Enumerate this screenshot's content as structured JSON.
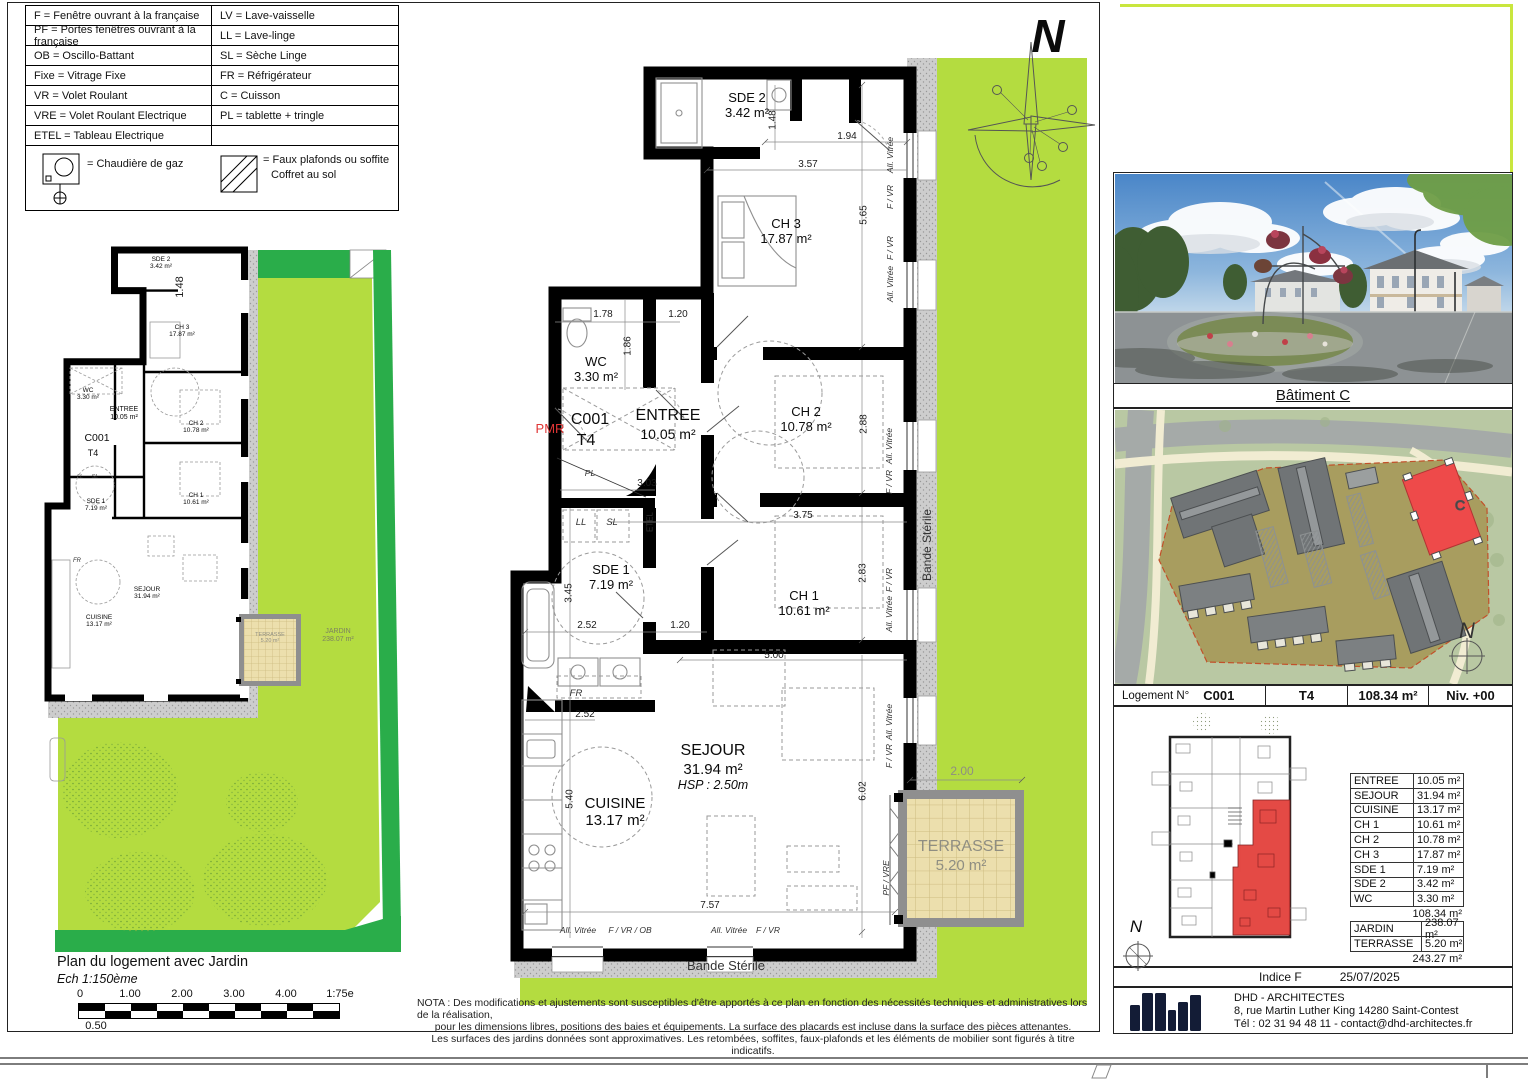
{
  "legend": {
    "rows": [
      {
        "l": "F = Fenêtre ouvrant à la française",
        "r": "LV = Lave-vaisselle"
      },
      {
        "l": "PF = Portes fenêtres ouvrant à la française",
        "r": "LL = Lave-linge"
      },
      {
        "l": "OB = Oscillo-Battant",
        "r": "SL = Sèche Linge"
      },
      {
        "l": "Fixe = Vitrage Fixe",
        "r": "FR = Réfrigérateur"
      },
      {
        "l": "VR = Volet Roulant",
        "r": "C = Cuisson"
      },
      {
        "l": "VRE = Volet Roulant Electrique",
        "r": "PL = tablette + tringle"
      },
      {
        "l": "ETEL = Tableau Electrique",
        "r": ""
      }
    ],
    "boiler": "= Chaudière de gaz",
    "soffit1": "= Faux plafonds ou soffite",
    "soffit2": "Coffret au sol"
  },
  "north": "N",
  "rooms": {
    "sde2": {
      "n": "SDE 2",
      "a": "3.42 m²"
    },
    "ch3": {
      "n": "CH 3",
      "a": "17.87 m²"
    },
    "wc": {
      "n": "WC",
      "a": "3.30 m²"
    },
    "entree": {
      "n": "ENTREE",
      "a": "10.05 m²"
    },
    "ch2": {
      "n": "CH 2",
      "a": "10.78 m²"
    },
    "sde1": {
      "n": "SDE 1",
      "a": "7.19 m²"
    },
    "ch1": {
      "n": "CH 1",
      "a": "10.61 m²"
    },
    "sejour": {
      "n": "SEJOUR",
      "a": "31.94 m²"
    },
    "cuisine": {
      "n": "CUISINE",
      "a": "13.17 m²"
    },
    "terrasse": {
      "n": "TERRASSE",
      "a": "5.20 m²"
    },
    "jardin": {
      "n": "JARDIN",
      "a": "238.07 m²"
    }
  },
  "unit": {
    "code": "C001",
    "type": "T4",
    "pmr": "PMR",
    "hsp": "HSP : 2.50m"
  },
  "dims": {
    "v148": "1.48",
    "v194": "1.94",
    "v357": "3.57",
    "v565": "5.65",
    "v178": "1.78",
    "v120": "1.20",
    "v186": "1.86",
    "v288": "2.88",
    "v303": "3.03",
    "v375": "3.75",
    "v283": "2.83",
    "v345": "3.45",
    "v252": "2.52",
    "v500": "5.00",
    "v540": "5.40",
    "v602": "6.02",
    "v757": "7.57",
    "v200": "2.00"
  },
  "tags": {
    "av": "All. Vitrée",
    "fvr": "F / VR",
    "fvrob": "F / VR / OB",
    "pfvre": "PF / VRE",
    "etel": "ETEL",
    "pl": "PL",
    "ll": "LL",
    "sl": "SL",
    "fr": "FR",
    "bande": "Bande Stérile"
  },
  "left_plan": {
    "title": "Plan du logement avec Jardin",
    "scale": "Ech 1:150ème",
    "bar_ticks": [
      "0",
      "1.00",
      "2.00",
      "3.00",
      "4.00"
    ],
    "bar_right": "1:75e",
    "bar_below": "0.50"
  },
  "nota": {
    "l1": "NOTA : Des modifications et ajustements sont susceptibles d'être apportés à ce plan en fonction des nécessités techniques et administratives lors de la réalisation,",
    "l2": "pour les dimensions libres, positions des baies et équipements. La surface des placards est incluse dans la surface des pièces attenantes.",
    "l3": "Les surfaces des jardins données sont approximatives. Les retombées, soffites, faux-plafonds et les éléments de mobilier sont figurés à titre indicatifs."
  },
  "panel": {
    "caption": "Bâtiment C",
    "site_label": "C",
    "info": {
      "label": "Logement N°",
      "code": "C001",
      "type": "T4",
      "area": "108.34 m²",
      "level": "Niv. +00"
    },
    "table": [
      [
        "ENTREE",
        "10.05 m²"
      ],
      [
        "SEJOUR",
        "31.94 m²"
      ],
      [
        "CUISINE",
        "13.17 m²"
      ],
      [
        "CH 1",
        "10.61 m²"
      ],
      [
        "CH 2",
        "10.78 m²"
      ],
      [
        "CH 3",
        "17.87 m²"
      ],
      [
        "SDE 1",
        "7.19 m²"
      ],
      [
        "SDE 2",
        "3.42 m²"
      ],
      [
        "WC",
        "3.30 m²"
      ]
    ],
    "subtotal": "108.34 m²",
    "outdoor": [
      [
        "JARDIN",
        "238.07 m²"
      ],
      [
        "TERRASSE",
        "5.20 m²"
      ]
    ],
    "total": "243.27 m²",
    "indice": "Indice F",
    "date": "25/07/2025",
    "firm": {
      "name": "DHD - ARCHITECTES",
      "addr": "8, rue Martin Luther King 14280 Saint-Contest",
      "tel": "Tél : 02 31 94 48 11 - contact@dhd-architectes.fr"
    }
  },
  "colors": {
    "grass": "#b4dc40",
    "hedge": "#2aad4a",
    "terrace": "#ecdfad",
    "unit_red": "#ee4a4a",
    "navy": "#131c36",
    "pmr": "#e03535"
  }
}
